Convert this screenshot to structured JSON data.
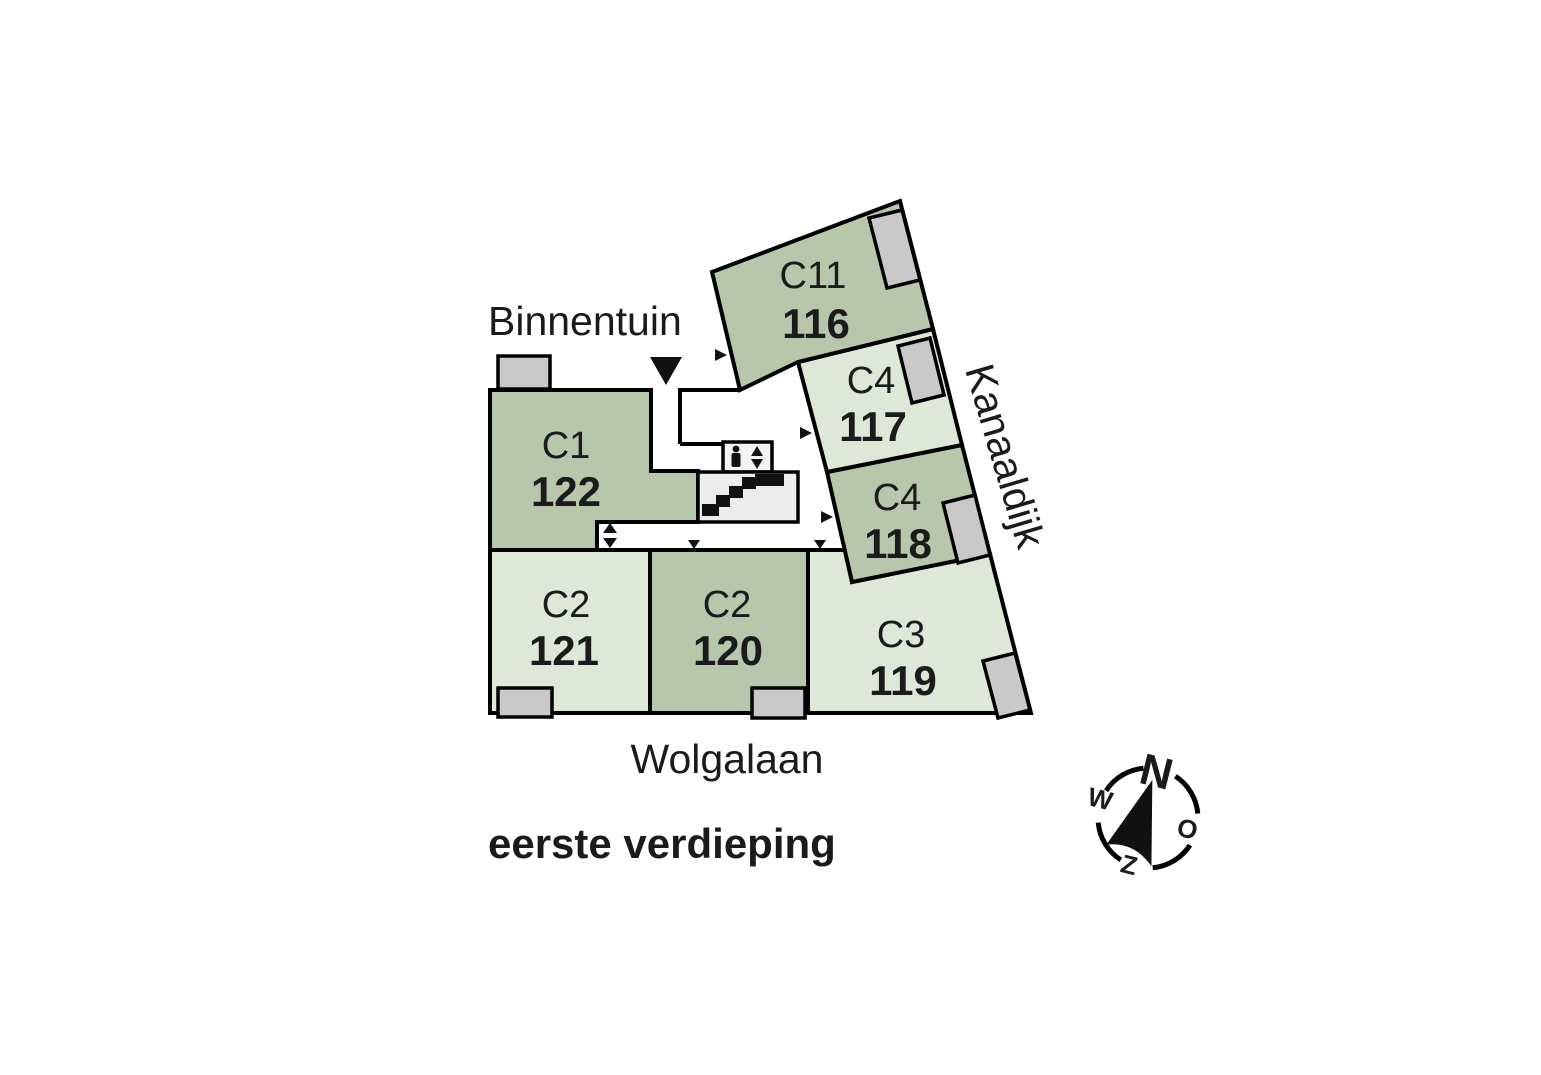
{
  "plan": {
    "title": "eerste verdieping",
    "streets": {
      "top": "Binnentuin",
      "bottom": "Wolgalaan",
      "right": "Kanaaldijk"
    },
    "units": [
      {
        "type": "C11",
        "number": "116"
      },
      {
        "type": "C4",
        "number": "117"
      },
      {
        "type": "C4",
        "number": "118"
      },
      {
        "type": "C3",
        "number": "119"
      },
      {
        "type": "C2",
        "number": "120"
      },
      {
        "type": "C2",
        "number": "121"
      },
      {
        "type": "C1",
        "number": "122"
      }
    ],
    "compass": {
      "north": "N",
      "east": "O",
      "south": "Z",
      "west": "W"
    },
    "colors": {
      "unit_medium": "#b6c7ac",
      "unit_light": "#dde8d6",
      "balcony": "#c9c9c9",
      "stairs_landing": "#ececec",
      "elevator": "#f3f3f3",
      "wall": "#000000",
      "text": "#1b1b1b",
      "background": "#ffffff"
    },
    "icons": {
      "entrance": "down-triangle",
      "door_marker": "small-triangle",
      "elevator": "person-with-up-down-arrows",
      "stairs": "staircase",
      "compass": "compass-rose"
    }
  }
}
